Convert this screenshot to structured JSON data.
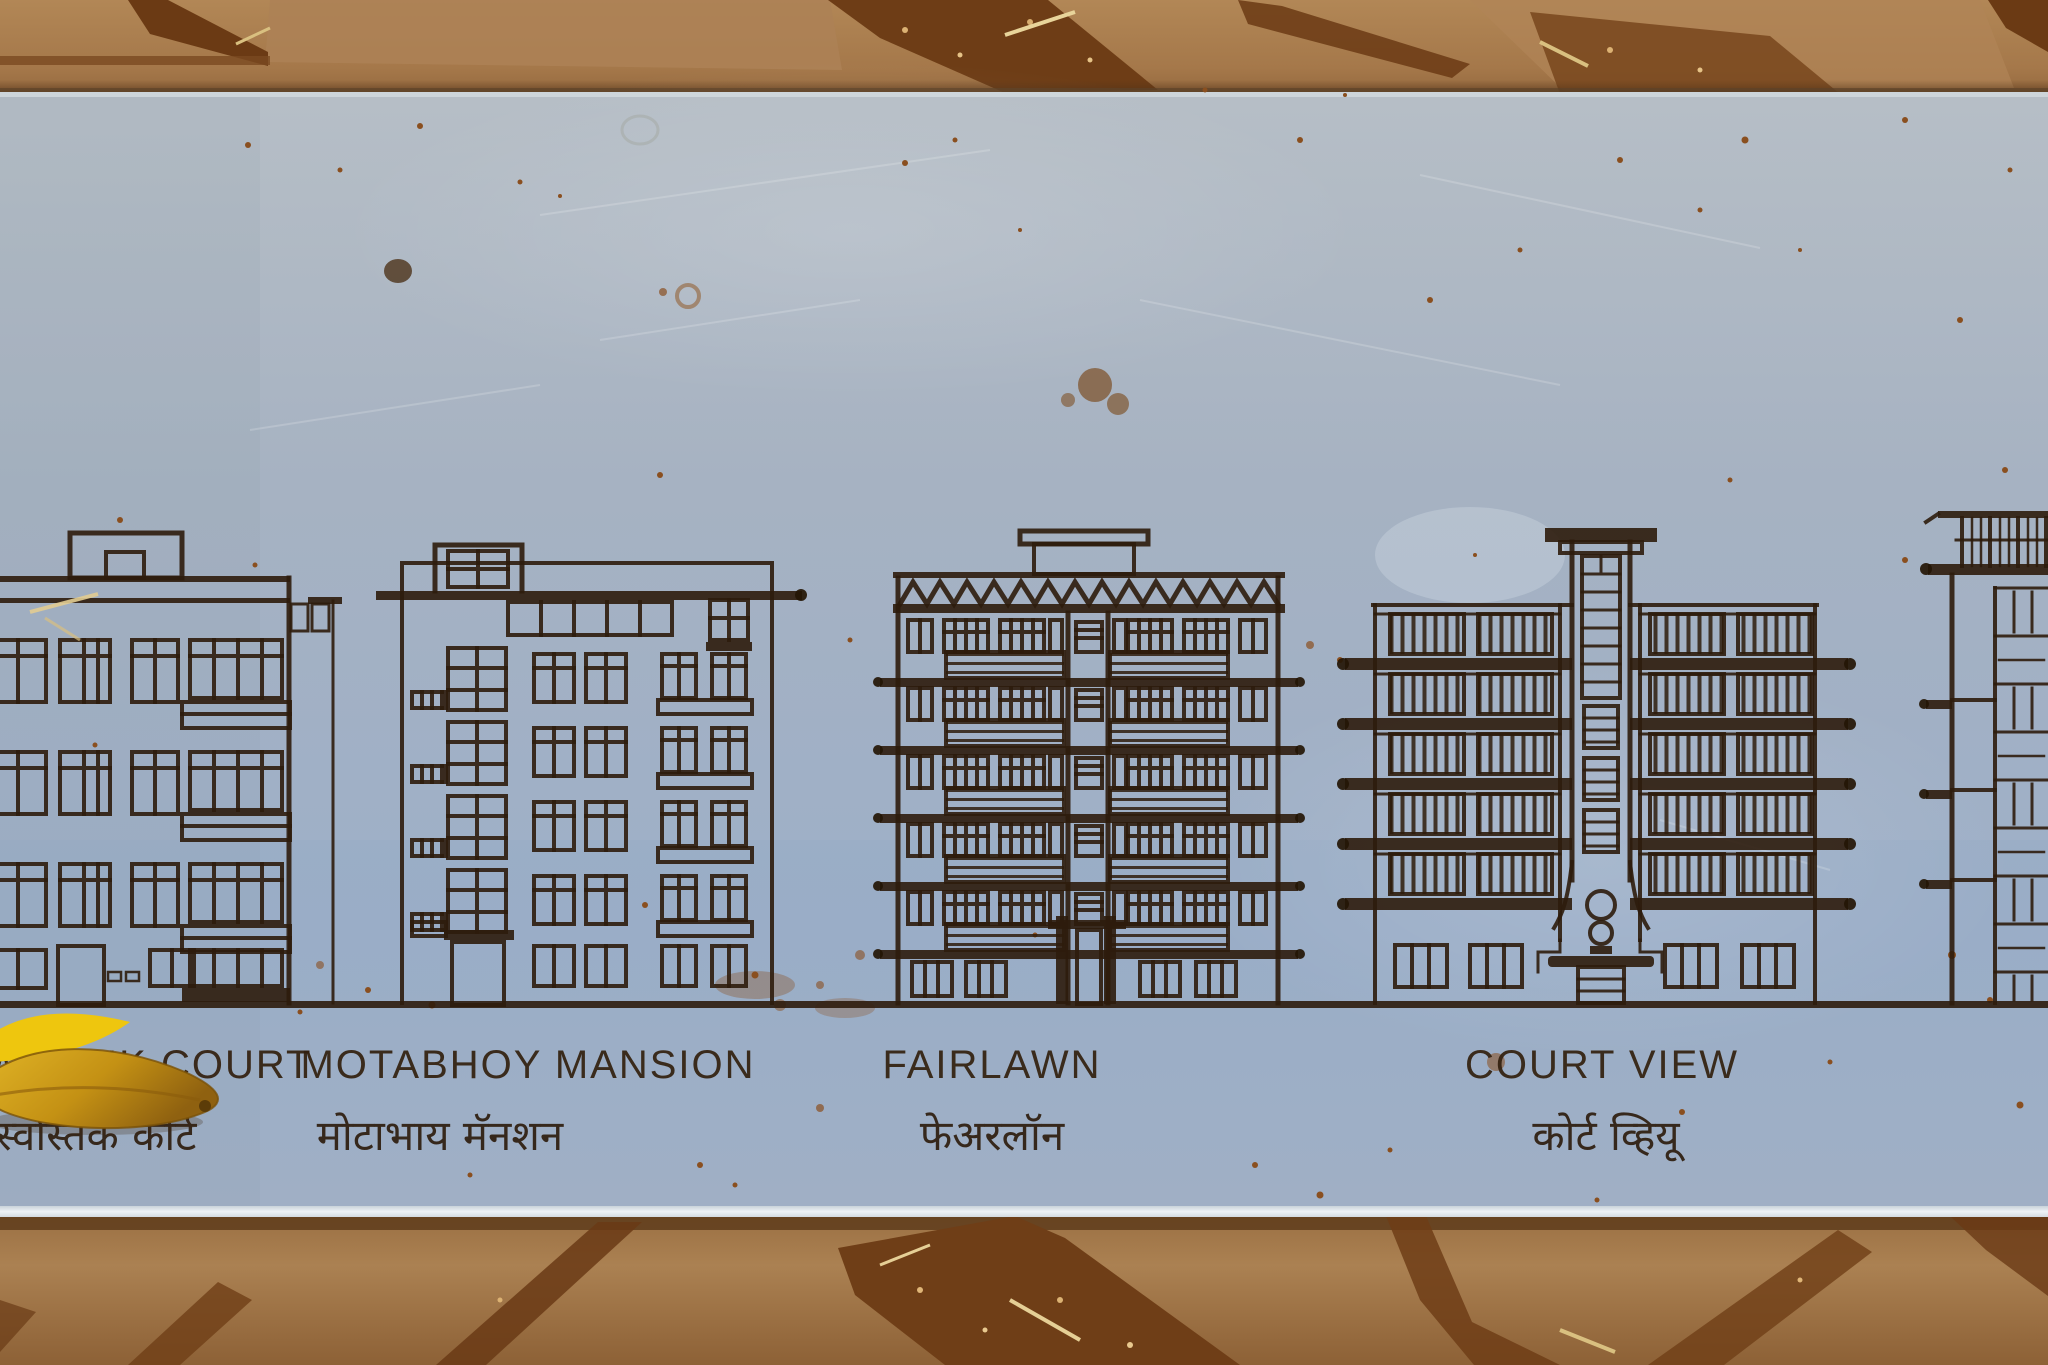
{
  "plaque": {
    "description": "etched-metal-heritage-plaque-with-building-elevations",
    "labels": [
      {
        "en": "WASTIK COURT",
        "mr": "स्वस्तिक कोर्ट"
      },
      {
        "en": "MOTABHOY MANSION",
        "mr": "मोटाभाय मॅनशन"
      },
      {
        "en": "FAIRLAWN",
        "mr": "फेअरलॉन"
      },
      {
        "en": "COURT VIEW",
        "mr": "कोर्ट व्हियू"
      }
    ],
    "colors": {
      "plate": "#a5b2c4",
      "etch_line": "#2e1c0c",
      "stone": "#a97e50",
      "dirt_joint": "#6b3a14",
      "leaf": "#d3a018"
    }
  }
}
